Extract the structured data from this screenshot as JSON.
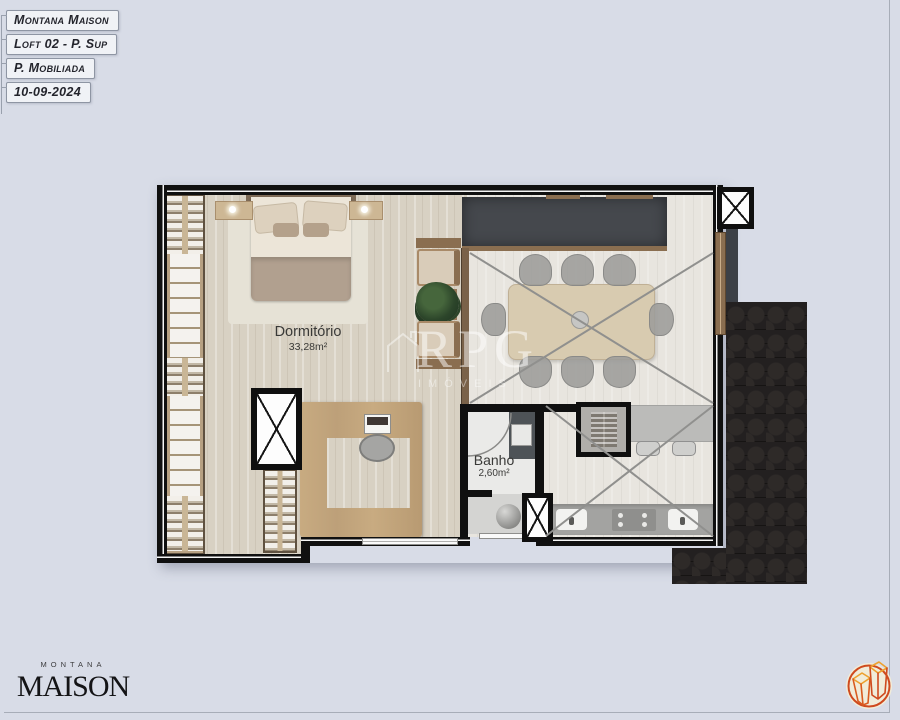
{
  "title_block": {
    "items": [
      "Montana Maison",
      "Loft 02 - P. Sup",
      "P. Mobiliada",
      "10-09-2024"
    ]
  },
  "rooms": [
    {
      "name": "Dormitório",
      "area": "33,28m²"
    },
    {
      "name": "Banho",
      "area": "2,60m²"
    }
  ],
  "watermark": {
    "brand": "RPG",
    "subtitle": "IMÓVEIS"
  },
  "footer": {
    "brand_top": "MONTANA",
    "brand_main": "MAISON"
  },
  "colors": {
    "page_bg": "#d8dce7",
    "wall": "#101010",
    "wood_floor": "#d8d1c3",
    "light_floor": "#e8e5df",
    "dark_counter": "#45484d",
    "wood_trim": "#8a6e50",
    "roof": "#232020",
    "logo_orange": "#cf4a1e",
    "logo_gold": "#eda12f"
  }
}
